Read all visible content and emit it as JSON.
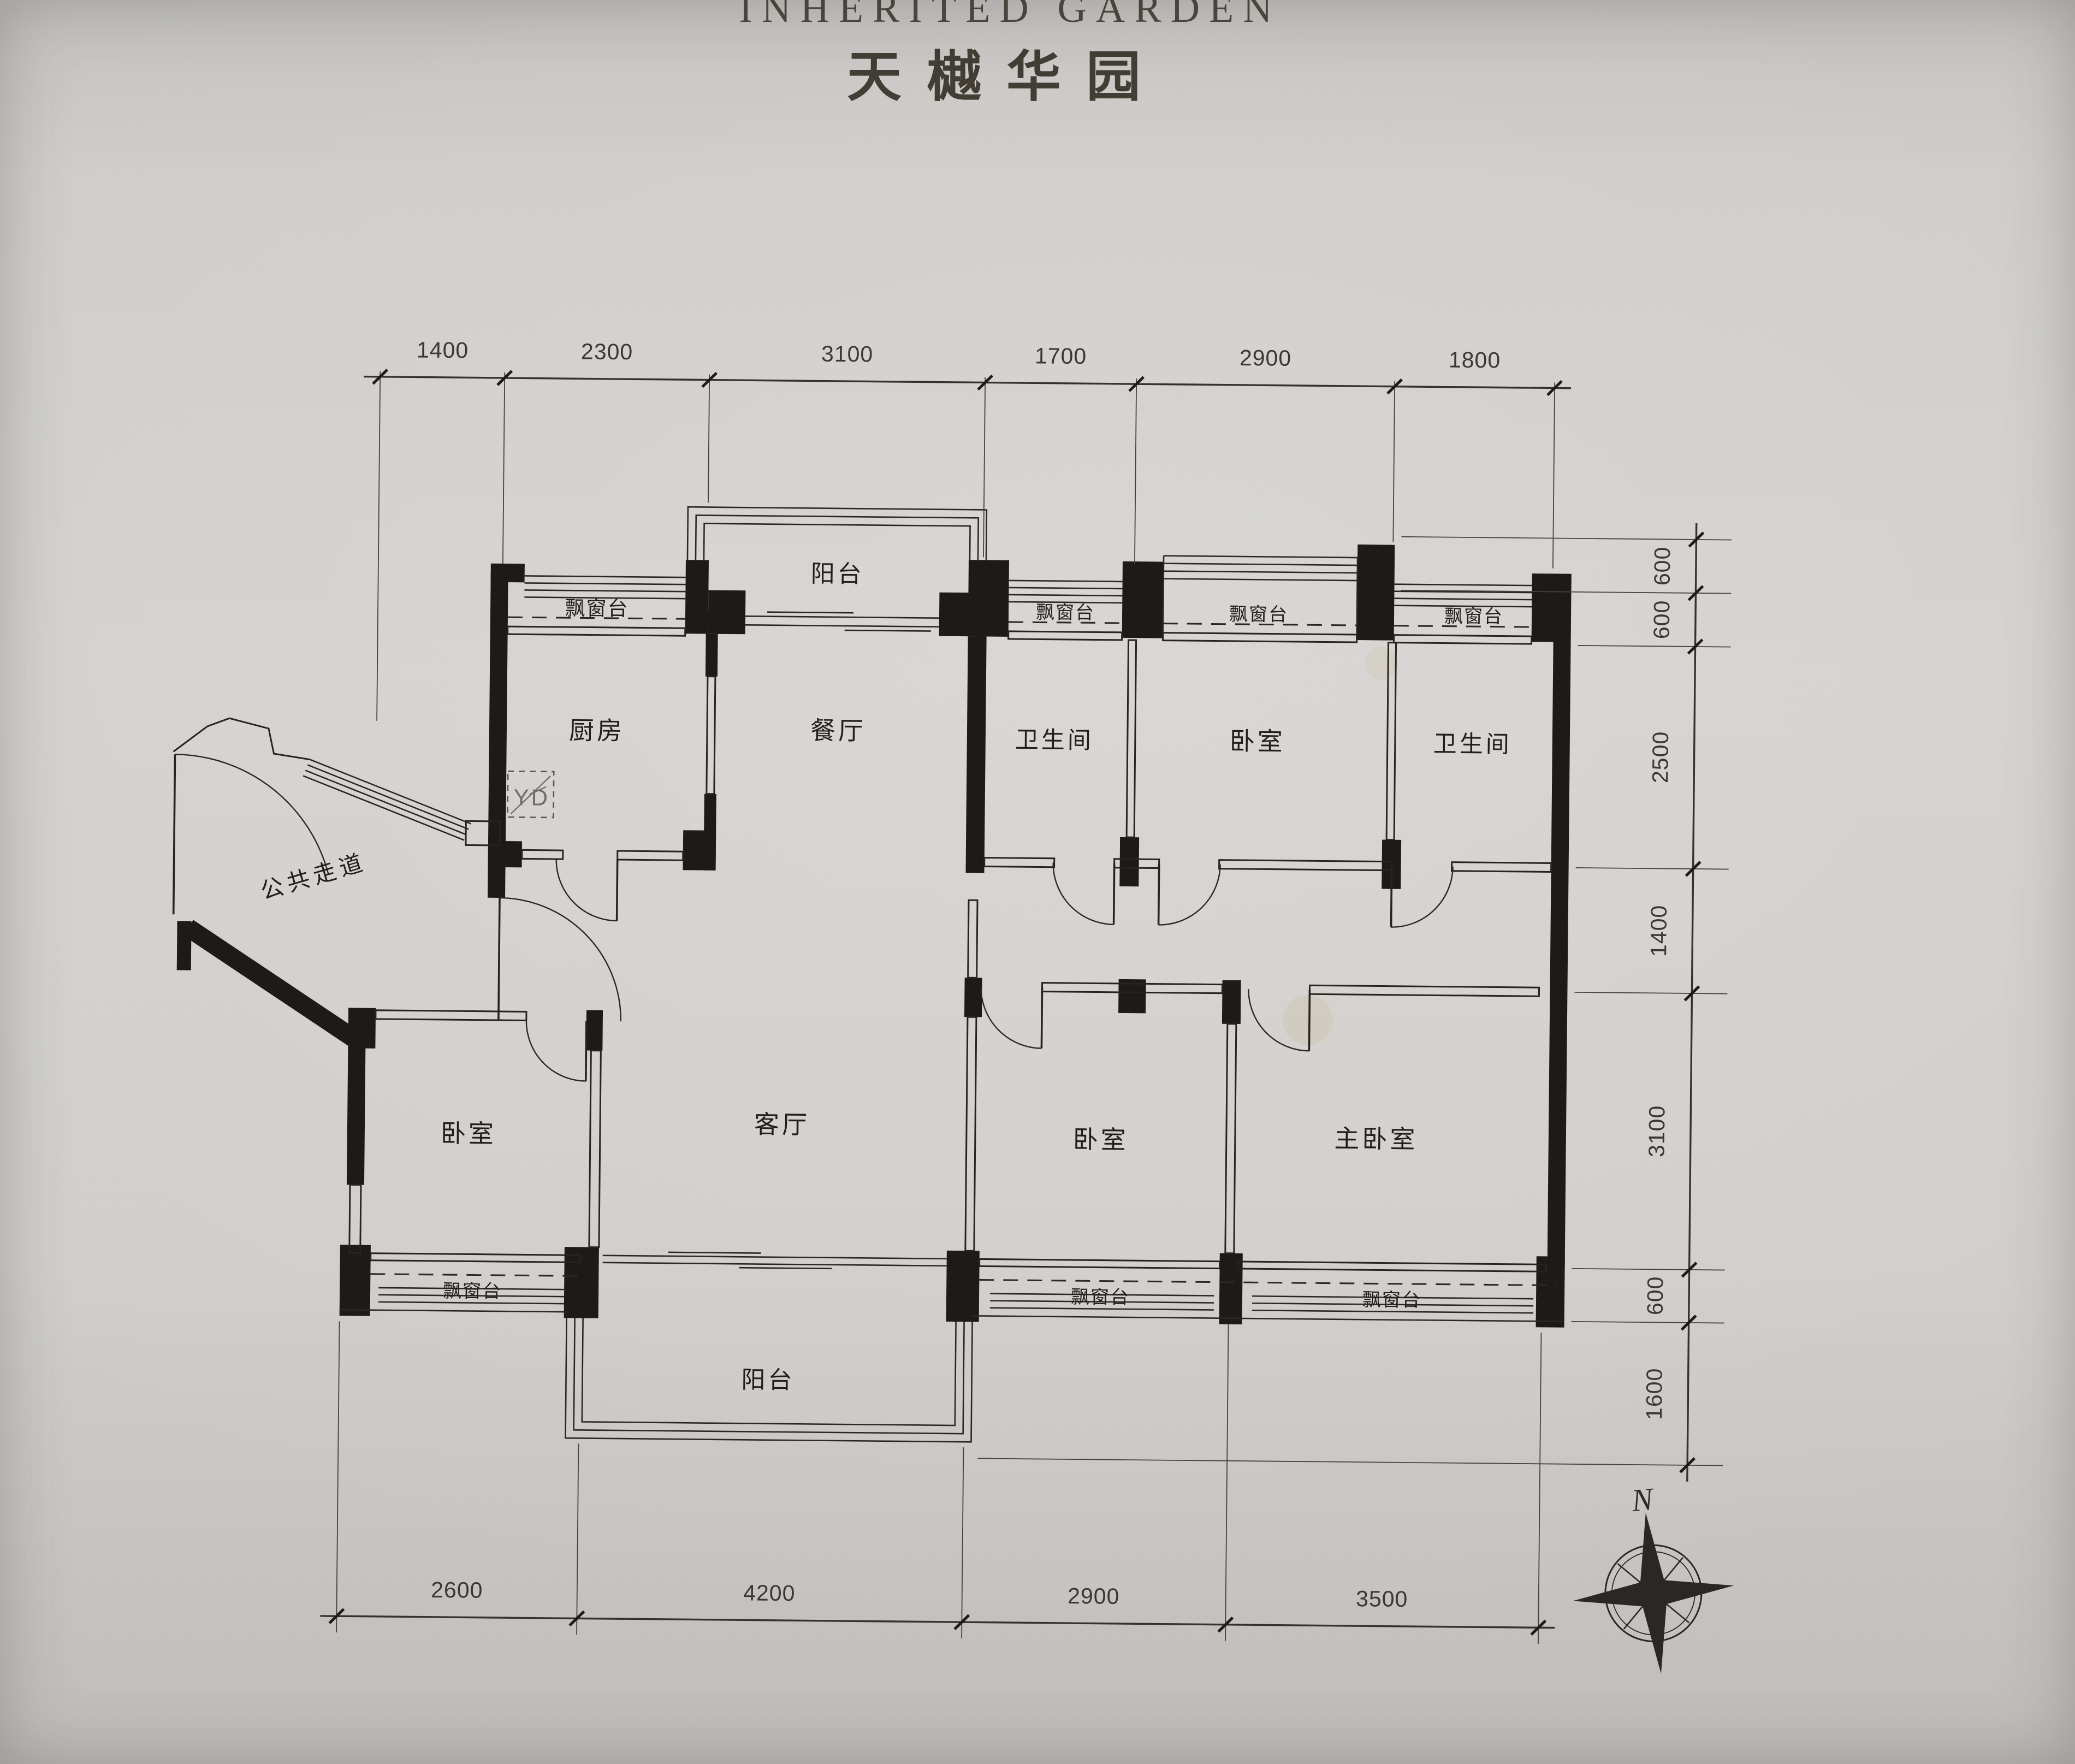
{
  "title": {
    "en": "INHERITED GARDEN",
    "zh": "天樾华园"
  },
  "labels": {
    "bay_window": "飘窗台",
    "yd_box": "YD",
    "north": "N"
  },
  "rooms": {
    "balcony_top": "阳台",
    "kitchen": "厨房",
    "dining": "餐厅",
    "bath_1": "卫生间",
    "bedroom_top": "卧室",
    "bath_2": "卫生间",
    "public_corridor": "公共走道",
    "bedroom_left": "卧室",
    "living": "客厅",
    "bedroom_mid": "卧室",
    "master_bedroom": "主卧室",
    "balcony_bottom": "阳台"
  },
  "dimensions": {
    "top": [
      "1400",
      "2300",
      "3100",
      "1700",
      "2900",
      "1800"
    ],
    "right": [
      "600",
      "600",
      "2500",
      "1400",
      "3100",
      "600",
      "1600"
    ],
    "bottom": [
      "2600",
      "4200",
      "2900",
      "3500"
    ]
  }
}
